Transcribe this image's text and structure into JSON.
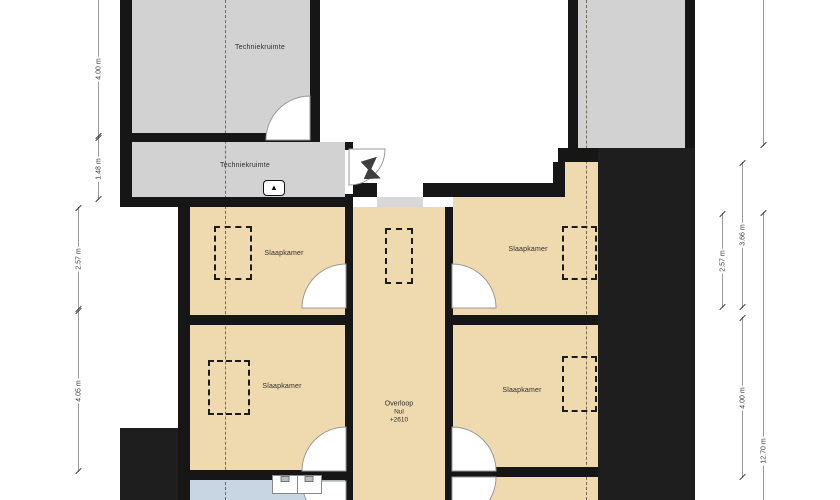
{
  "plan": {
    "type": "floor-plan",
    "floor": "attic / second floor",
    "language": "nl"
  },
  "palette": {
    "wall": "#161616",
    "dark_zone": "#1e1e1e",
    "room_beige": "#efd9ae",
    "room_gray": "#d2d2d2",
    "bathroom_blue": "#c8d5e2",
    "dimension_line": "#9a9a9a",
    "label_text": "#2e2e2e"
  },
  "rooms": {
    "techniek_top": {
      "label": "Techniekruimte"
    },
    "techniek_bottom": {
      "label": "Techniekruimte"
    },
    "bedroom_top_left": {
      "label": "Slaapkamer"
    },
    "bedroom_bottom_left": {
      "label": "Slaapkamer"
    },
    "bedroom_top_right": {
      "label": "Slaapkamer"
    },
    "bedroom_bottom_right": {
      "label": "Slaapkamer"
    },
    "landing": {
      "label": "Overloop",
      "line2": "Nul",
      "line3": "+2610"
    }
  },
  "dimensions": {
    "left_top": "4.00 m",
    "left_top2": "1.48 m",
    "left_mid": "2.57 m",
    "left_bottom": "4.05 m",
    "right_inner": "2.57 m",
    "right_mid_top": "3.66 m",
    "right_mid_bottom": "4.00 m",
    "right_outer": "12.70 m"
  },
  "symbols": {
    "north_badge": "▲"
  }
}
